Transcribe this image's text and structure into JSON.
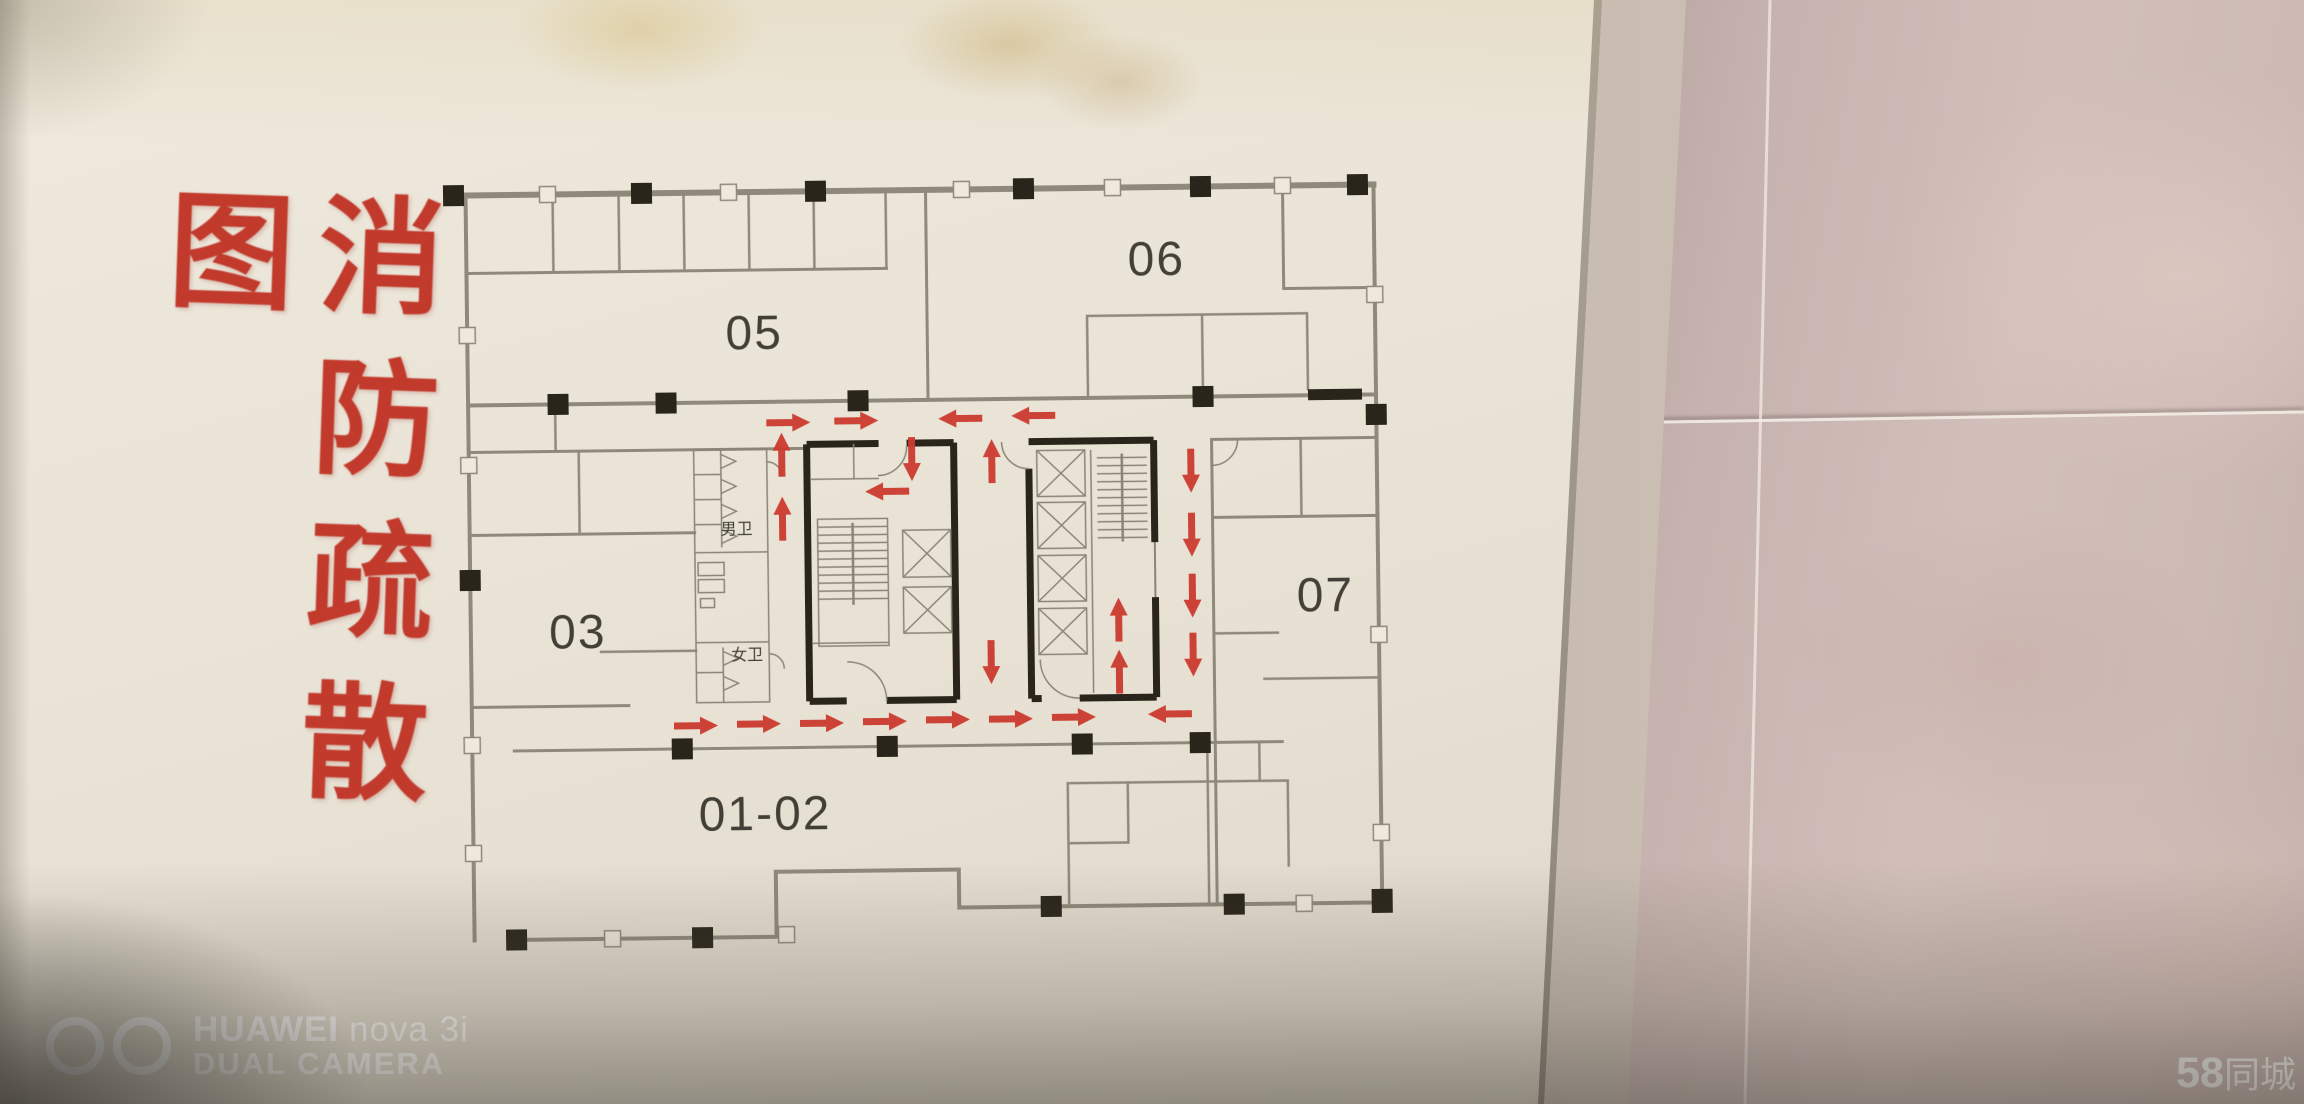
{
  "sign": {
    "title": "消防疏散图",
    "title_color": "#c13a2c"
  },
  "floor_plan": {
    "rooms": [
      {
        "id": "05",
        "label": "05",
        "x": 757,
        "y": 347
      },
      {
        "id": "06",
        "label": "06",
        "x": 1160,
        "y": 278
      },
      {
        "id": "03",
        "label": "03",
        "x": 577,
        "y": 644
      },
      {
        "id": "07",
        "label": "07",
        "x": 1325,
        "y": 616
      },
      {
        "id": "01-02",
        "label": "01-02",
        "x": 762,
        "y": 828
      }
    ],
    "facilities": [
      {
        "id": "toilet-male",
        "label": "男卫",
        "x": 737,
        "y": 532
      },
      {
        "id": "toilet-female",
        "label": "女卫",
        "x": 746,
        "y": 658
      }
    ],
    "evacuation_arrows": [
      {
        "dir": "right",
        "x": 790,
        "y": 421
      },
      {
        "dir": "right",
        "x": 858,
        "y": 420
      },
      {
        "dir": "left",
        "x": 962,
        "y": 419
      },
      {
        "dir": "left",
        "x": 1035,
        "y": 417
      },
      {
        "dir": "down",
        "x": 913,
        "y": 459
      },
      {
        "dir": "left",
        "x": 888,
        "y": 491
      },
      {
        "dir": "up",
        "x": 783,
        "y": 453
      },
      {
        "dir": "up",
        "x": 783,
        "y": 517
      },
      {
        "dir": "up",
        "x": 993,
        "y": 462
      },
      {
        "dir": "down",
        "x": 990,
        "y": 663
      },
      {
        "dir": "down",
        "x": 1192,
        "y": 474
      },
      {
        "dir": "down",
        "x": 1192,
        "y": 538
      },
      {
        "dir": "down",
        "x": 1192,
        "y": 599
      },
      {
        "dir": "down",
        "x": 1192,
        "y": 658
      },
      {
        "dir": "up",
        "x": 1118,
        "y": 622
      },
      {
        "dir": "up",
        "x": 1118,
        "y": 674
      },
      {
        "dir": "right",
        "x": 694,
        "y": 723
      },
      {
        "dir": "right",
        "x": 757,
        "y": 722
      },
      {
        "dir": "right",
        "x": 820,
        "y": 722
      },
      {
        "dir": "right",
        "x": 883,
        "y": 721
      },
      {
        "dir": "right",
        "x": 946,
        "y": 720
      },
      {
        "dir": "right",
        "x": 1009,
        "y": 720
      },
      {
        "dir": "right",
        "x": 1072,
        "y": 719
      },
      {
        "dir": "left",
        "x": 1168,
        "y": 717
      }
    ],
    "arrow_color": "#cb3a2e",
    "wall_color": "#29251b",
    "line_color": "#8f897c"
  },
  "watermarks": {
    "camera": {
      "brand": "HUAWEI",
      "model": "nova 3i",
      "caption": "DUAL CAMERA"
    },
    "site": {
      "number": "58",
      "name": "同城"
    }
  }
}
